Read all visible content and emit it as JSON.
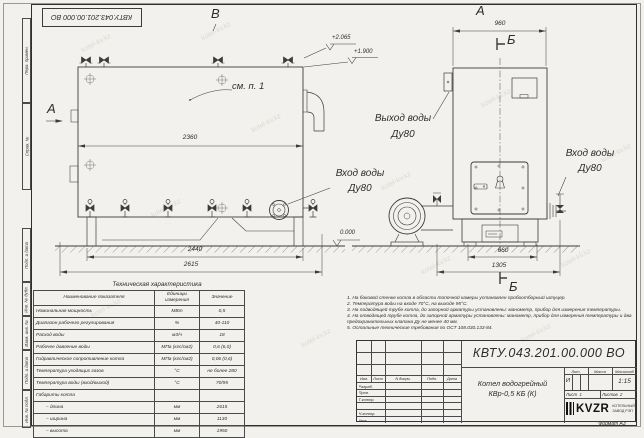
{
  "watermark": "kotel-kv.kz",
  "stamp_top": "КВТУ.043.201.00.000  ВО",
  "frame": {
    "left_labels": [
      "Перв. примен.",
      "Справ. №",
      "Подп. и дата",
      "Инв. № дубл.",
      "Взам. инв. №",
      "Подп. и дата",
      "Инв. № подл."
    ],
    "format": "Формат  А3"
  },
  "views": {
    "side": {
      "label": "В",
      "view_arrow": "А",
      "callout": "см. п. 1",
      "dim_width": "2360",
      "dim_base": "2440",
      "dim_total": "2615",
      "elev_top": "+2.065",
      "elev_mid": "+1.900",
      "elev_zero": "0.000",
      "inlet_label_1": "Вход воды",
      "inlet_label_2": "Ду80"
    },
    "front": {
      "label": "А",
      "section_top": "Б",
      "section_bottom": "Б",
      "dim_width": "960",
      "dim_base": "660",
      "dim_total": "1305",
      "outlet_label_1": "Выход воды",
      "outlet_label_2": "Ду80",
      "inlet_label_1": "Вход воды",
      "inlet_label_2": "Ду80"
    }
  },
  "tech_table": {
    "title": "Техническая характеристика",
    "col_name": "Наименование показателя",
    "col_units": "Единицы измерения",
    "col_value": "Значение",
    "rows": [
      {
        "name": "Номинальная мощность",
        "units": "МВт",
        "value": "0,5"
      },
      {
        "name": "Диапазон рабочего регулирования",
        "units": "%",
        "value": "40-110"
      },
      {
        "name": "Расход воды",
        "units": "м3/ч",
        "value": "18"
      },
      {
        "name": "Рабочее давление воды",
        "units": "МПа (кгс/см2)",
        "value": "0,6 (6,0)"
      },
      {
        "name": "Гидравлическое сопротивление котла",
        "units": "МПа (кгс/см2)",
        "value": "0,06 (0,6)"
      },
      {
        "name": "Температура уходящих газов",
        "units": "°С",
        "value": "не более 280"
      },
      {
        "name": "Температура воды (вход/выход)",
        "units": "°С",
        "value": "70/95"
      },
      {
        "name": "Габариты котла",
        "units": "",
        "value": ""
      },
      {
        "name": "– длина",
        "units": "мм",
        "value": "2615"
      },
      {
        "name": "– ширина",
        "units": "мм",
        "value": "1130"
      },
      {
        "name": "– высота",
        "units": "мм",
        "value": "1950"
      }
    ]
  },
  "notes": {
    "n1": "1.  На боковой стенке котла в области топочной камеры установлен пробоотборный штуцер.",
    "n2": "2.  Температура воды на входе 70°С, на выходе 95°С.",
    "n3": "3.  На подводящей трубе котла, до запорной арматуры установлены: манометр, прибор для измерения температуры.",
    "n4": "4.  На отводящей трубе котла, до запорной арматуры установлены: манометр, прибор для измерения температуры и два предохранительных клапана  Ду не менее 40 мм.",
    "n5": "5.  Остальные технические требования по ОСТ 108.030.133-84."
  },
  "title_block": {
    "designation": "КВТУ.043.201.00.000  ВО",
    "name_line1": "Котел водогрейный",
    "name_line2": "КВр-0,5 КБ (К)",
    "lit_header": "Лит.",
    "mass_header": "Масса",
    "scale_header": "Масштаб",
    "lit": "И",
    "mass": "",
    "scale": "1:15",
    "sheet_label": "Лист",
    "sheet_no": "1",
    "sheets_label": "Листов",
    "sheets_no": "2",
    "col_izm": "Изм.",
    "col_list": "Лист",
    "col_doc": "N докум.",
    "col_sign": "Подп.",
    "col_date": "Дата",
    "row_razrab": "Разраб.",
    "row_prov": "Пров.",
    "row_tkontr": "Т.контр.",
    "row_nkontr": "Н.контр.",
    "row_utv": "Утв.",
    "logo": "KVZR",
    "logo_sub1": "КОТЕЛЬНЫЙ",
    "logo_sub2": "ЗАВОД РЭП"
  }
}
